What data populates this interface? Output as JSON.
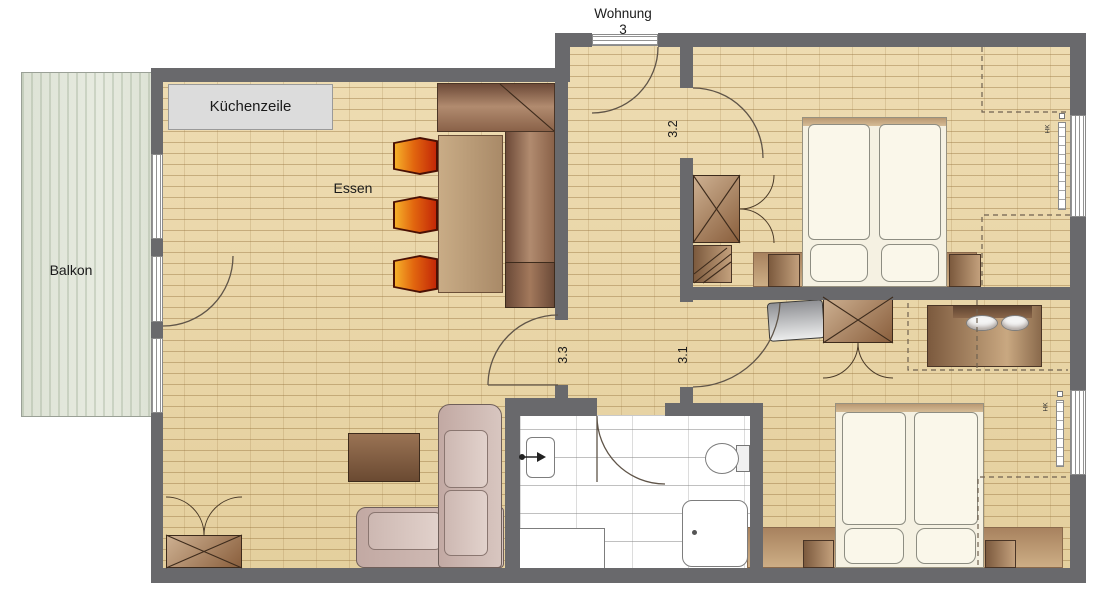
{
  "title": {
    "line1": "Wohnung",
    "line2": "3"
  },
  "areas": {
    "balcony": {
      "label": "Balkon"
    },
    "kitchen": {
      "label": "Küchenzeile"
    },
    "dining": {
      "label": "Essen"
    },
    "living_room": {
      "number": "3.3"
    },
    "bedroom_upper": {
      "number": "3.2"
    },
    "bedroom_lower": {
      "number": "3.1"
    }
  },
  "fixtures": {
    "radiator_label": "HK"
  },
  "colors": {
    "wall": "#69696c",
    "floor": "#e9d6a8",
    "balcony": "#e0e5d9",
    "kitchen_counter": "#dcdcdc",
    "chair_orange": "#f6b02a",
    "chair_red": "#c32807",
    "wood_dark": "#7c5a3e",
    "wood_light": "#c9a881",
    "sofa": "#cbb6b0",
    "bed_linen": "#faf7ea",
    "dash_line": "#6f6150"
  }
}
